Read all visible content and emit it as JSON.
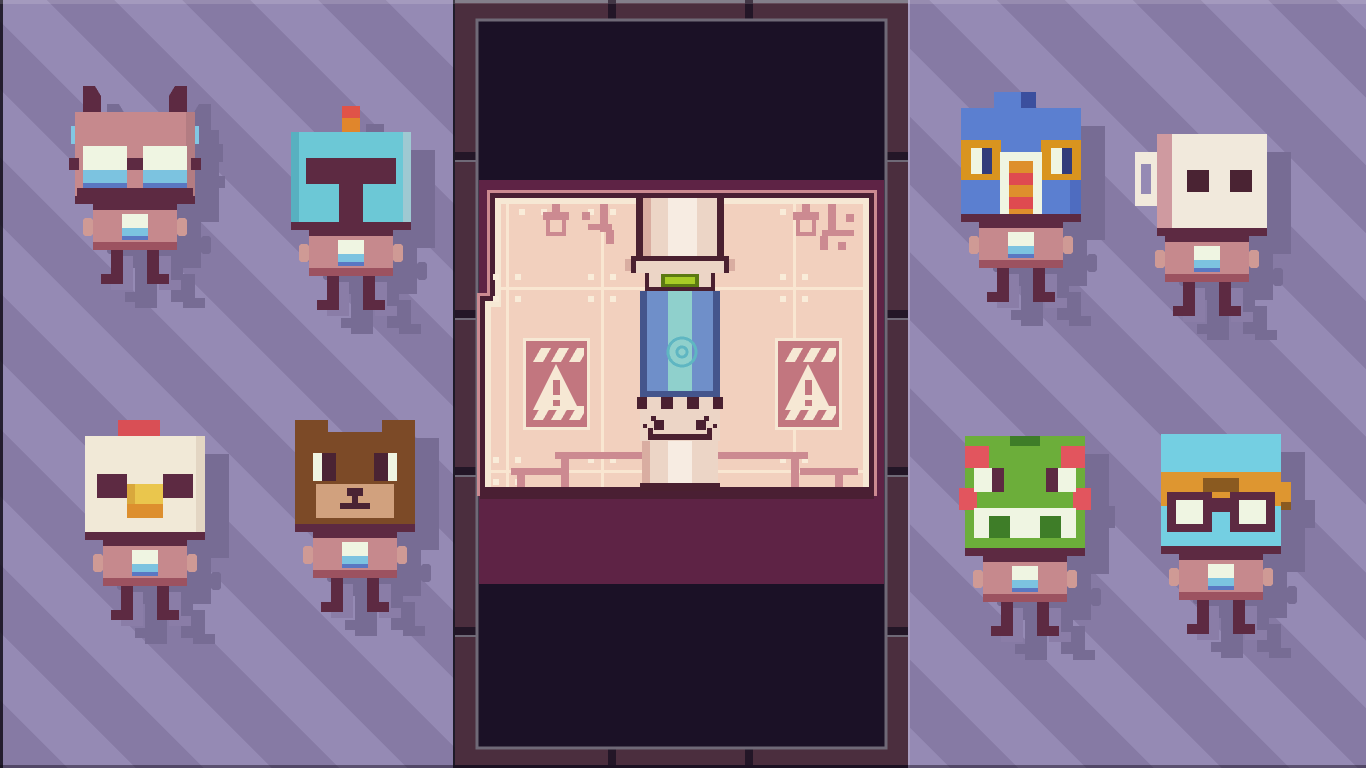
{
  "screen": {
    "title": "Pixel-art character select",
    "type": "game-screen",
    "visible_text": "none"
  },
  "palette": {
    "bg_base": "#867aa4",
    "bg_stripe": "#958ab4",
    "bg_edge_light": "#a89dc0",
    "char_shadow": "#776c94",
    "frame": "#4b2e3e",
    "frame_seam": "#231627",
    "frame_steel": "#6f6977",
    "void_black": "#1b1126",
    "magenta": "#5e2345",
    "room_rose": "#cc8a91",
    "room_dark": "#4a1f33",
    "room_cream": "#f6e8d4",
    "wall": "#f2d0be",
    "wall_line": "#f9e6d1",
    "rivet": "#f9ecd9",
    "sign_rose": "#c2767f",
    "dark_maroon": "#5d2a42",
    "torso": "#c6898d",
    "torso_shade": "#b37c82",
    "arm": "#cf9a95",
    "hem": "#9c5260",
    "chest_white": "#eff5e2",
    "chest_blue": "#7cc3e0",
    "chest_navy": "#5a77c2",
    "leg": "#5d2a42",
    "leg_shadow": "#8a7da7",
    "blue_nub": "#82c7e3",
    "teal_helmet": "#6cc8d6",
    "teal_shade": "#58b0c0",
    "teal_light": "#9fc9d2",
    "antenna_red": "#e05348",
    "antenna_orange": "#e0862c",
    "cream_head": "#f1e9d7",
    "cream_shade": "#e3d6c3",
    "comb_red": "#d94f55",
    "beak_yellow": "#eac64d",
    "beak_shade": "#d9a83c",
    "beak_orange": "#dd8f2e",
    "brown": "#7c4a27",
    "tan": "#d1a17e",
    "eye_dark": "#4a2333",
    "bird_blue": "#5b7fd0",
    "bird_blue_shade": "#4e6cc0",
    "bird_navy": "#3b4f9e",
    "pupil_navy": "#323c7a",
    "patch_orange": "#d9941f",
    "snood_red": "#df4a50",
    "snood_orange": "#de8f2c",
    "mug_cream": "#f1e9dc",
    "mug_pink": "#cf9aa0",
    "frog_green": "#6cae3a",
    "frog_dark": "#3e7d28",
    "frog_red": "#e2555e",
    "cyan": "#74cfe2",
    "band_orange": "#de9630",
    "strap_brown": "#8a5a20",
    "capsule_cream": "#ecd5c6",
    "capsule_white": "#f7ece2",
    "capsule_shade": "#d9ada1",
    "capsule_dark": "#4a2030",
    "glow_dim": "#5c7a12",
    "glow": "#a8cc26",
    "curtain_navy": "#44558c",
    "curtain_blue": "#6f8fc9",
    "curtain_teal": "#8fd0cc",
    "emblem": "#5fb6c2"
  },
  "characters": [
    {
      "id": "bat",
      "label": "bat-eared robot with glasses",
      "position": "left-top-1"
    },
    {
      "id": "robot",
      "label": "teal helmet robot with antenna",
      "position": "left-top-2"
    },
    {
      "id": "chicken",
      "label": "chicken-head robot",
      "position": "left-bottom-1"
    },
    {
      "id": "bear",
      "label": "bear-head robot",
      "position": "left-bottom-2"
    },
    {
      "id": "bird",
      "label": "blue bird robot with striped wattle",
      "position": "right-top-1"
    },
    {
      "id": "mug",
      "label": "mug-head robot",
      "position": "right-top-2"
    },
    {
      "id": "frog",
      "label": "frog-head robot",
      "position": "right-bottom-1"
    },
    {
      "id": "goggles",
      "label": "aviator robot with goggles",
      "position": "right-bottom-2"
    }
  ],
  "center_panel": {
    "description": "vertical viewport framed in dark metal showing a capsule room",
    "elements": [
      "tiled pink wall",
      "hanging lamp x2",
      "ceiling pipes",
      "warning sign x2",
      "cryo capsule with green light, blue curtain and face base",
      "side railings"
    ]
  }
}
